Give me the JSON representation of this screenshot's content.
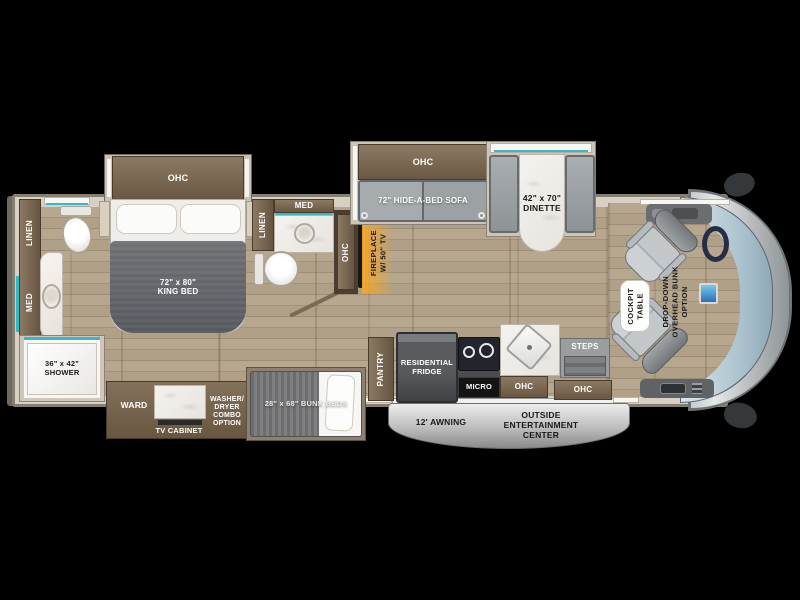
{
  "scene": {
    "type": "rv-floorplan-diagram",
    "description": "Top-down motorhome floor plan on black background"
  },
  "colors": {
    "background": "#000000",
    "wall_beige": "#d8d1c3",
    "wood_light": "#b7a78f",
    "wood_dark": "#9e8d75",
    "cabinet_brown": "#6a5843",
    "teal_accent": "#35b9c9",
    "sofa_gray": "#9aa0a4",
    "blanket_gray": "#64676b",
    "marble_white": "#f4f2ee",
    "fireplace_glow": "#f6a426",
    "awning_gray": "#b9b9b9",
    "windshield_blue": "#a7c0cc"
  },
  "labels": {
    "bedroom": {
      "ohc": "OHC",
      "king_bed": "72\" x 80\"\nKING BED"
    },
    "rear_bath": {
      "linen": "LINEN",
      "med": "MED",
      "shower": "36\" x 42\"\nSHOWER"
    },
    "wardrobe_slide": {
      "ward": "WARD",
      "tv_cabinet": "TV CABINET",
      "washer_dryer": "WASHER/\nDRYER\nCOMBO\nOPTION"
    },
    "bunk_room": {
      "bunk_beds": "28\" x 68\" BUNK BEDS"
    },
    "mid_bath": {
      "linen": "LINEN",
      "med": "MED"
    },
    "living": {
      "ohc_wall": "OHC",
      "fireplace": "FIREPLACE\nW/ 50\" TV",
      "sofa_ohc": "OHC",
      "sofa": "72\" HIDE-A-BED SOFA",
      "dinette": "42\" x 70\"\nDINETTE"
    },
    "kitchen": {
      "pantry": "PANTRY",
      "fridge": "RESIDENTIAL\nFRIDGE",
      "micro": "MICRO",
      "ohc": "OHC"
    },
    "entry": {
      "steps": "STEPS",
      "ohc": "OHC"
    },
    "exterior": {
      "awning": "12' AWNING",
      "outside_entertainment": "OUTSIDE\nENTERTAINMENT\nCENTER"
    },
    "cockpit": {
      "table": "COCKPIT\nTABLE",
      "bunk_option": "DROP-DOWN\nOVERHEAD BUNK\nOPTION"
    }
  }
}
